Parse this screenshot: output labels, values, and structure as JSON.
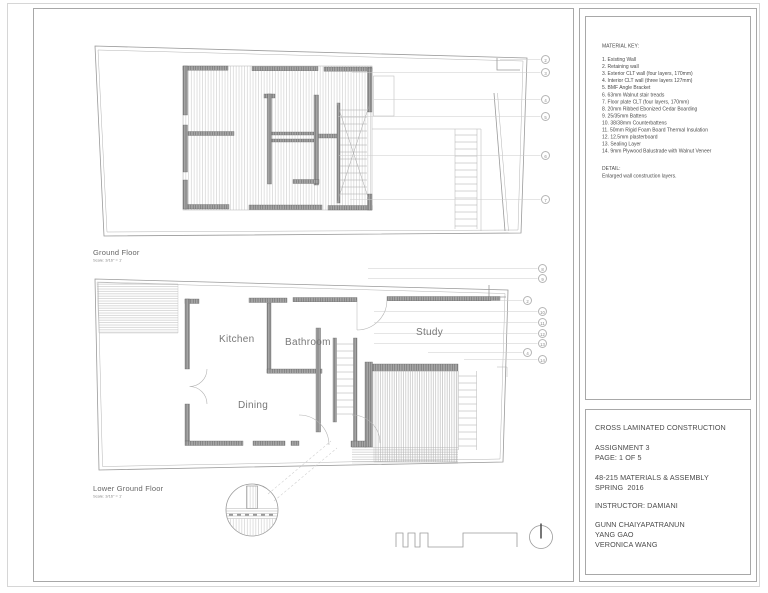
{
  "material_key": {
    "title": "MATERIAL KEY:",
    "items": [
      "1. Existing Wall",
      "2. Retaining wall",
      "3. Exterior CLT wall (four layers, 170mm)",
      "4. Interior CLT wall (three layers 127mm)",
      "5. BMF Angle Bracket",
      "6. 63mm Walnut stair treads",
      "7. Floor plate CLT (four layers, 170mm)",
      "8. 20mm Ribbed Ebonized Cedar Boarding",
      "9. 25/35mm Battens",
      "10. 38/38mm Counterbattens",
      "11. 50mm Rigid Foam Board Thermal Insulation",
      "12. 12.5mm plasterboard",
      "13. Sealing Layer",
      "14. 9mm Plywood Balustrade with Walnut Veneer"
    ]
  },
  "detail_note": {
    "title": "DETAIL:",
    "text": "Enlarged wall construction layers."
  },
  "plans": {
    "ground": {
      "label": "Ground Floor",
      "scale": "Scale: 3/16\" = 1'",
      "callouts": [
        "2",
        "3",
        "4",
        "5",
        "6",
        "7"
      ]
    },
    "lower": {
      "label": "Lower Ground Floor",
      "scale": "Scale: 3/16\" = 1'",
      "rooms": [
        "Kitchen",
        "Bathroom",
        "Dining",
        "Study"
      ],
      "callouts": [
        "8",
        "9",
        "2",
        "10",
        "11",
        "12",
        "13",
        "4",
        "14"
      ]
    }
  },
  "title_block": {
    "project": "CROSS LAMINATED CONSTRUCTION",
    "assignment": "ASSIGNMENT 3",
    "page": "PAGE: 1 OF 5",
    "course": "48-215 MATERIALS & ASSEMBLY",
    "term": "SPRING  2016",
    "instructor": "INSTRUCTOR: DAMIANI",
    "authors": [
      "GUNN CHAIYAPATRANUN",
      "YANG GAO",
      "VERONICA WANG"
    ]
  },
  "colors": {
    "linework": "#9a9a9a",
    "wall_fill": "#a8a8a8",
    "text": "#4a4a4a",
    "leader": "#cccccc"
  }
}
